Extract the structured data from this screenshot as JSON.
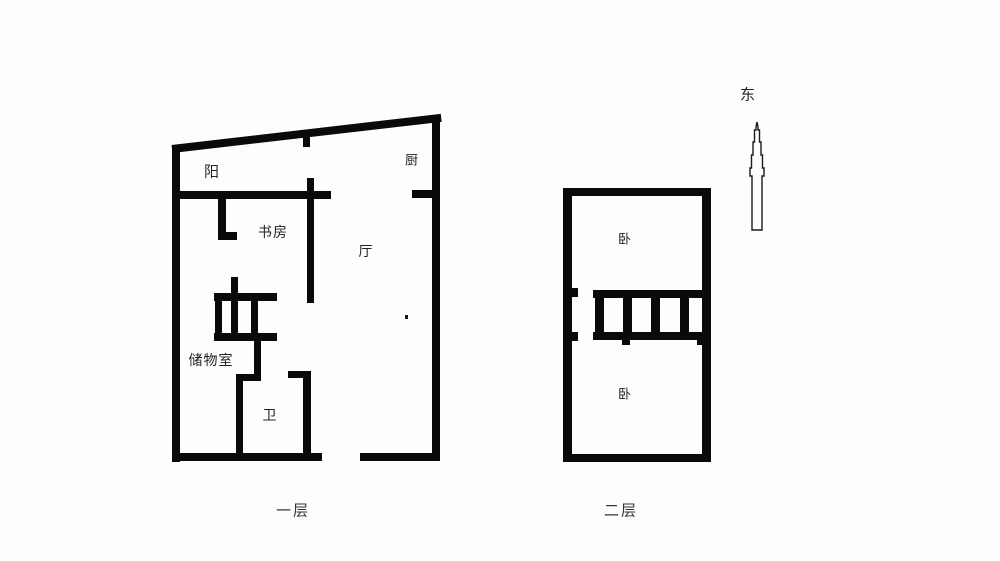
{
  "colors": {
    "background": "#fdfdfd",
    "wall": "#0a0a0a",
    "text": "#222222"
  },
  "compass": {
    "direction_label": "东"
  },
  "floor1": {
    "caption": "一层",
    "room_labels": {
      "balcony": "阳",
      "kitchen": "厨",
      "study": "书房",
      "living_room": "厅",
      "storage": "储物室",
      "bathroom": "卫"
    }
  },
  "floor2": {
    "caption": "二层",
    "room_labels": {
      "bedroom_upper": "卧",
      "bedroom_lower": "卧"
    }
  },
  "geometry": {
    "floor1_slant_wall": {
      "x": 172,
      "y": 145,
      "length": 271,
      "thickness": 8,
      "angle_deg": -6.6
    },
    "floor1_walls": [
      {
        "name": "left-wall",
        "x": 172,
        "y": 146,
        "w": 8,
        "h": 316
      },
      {
        "name": "right-wall",
        "x": 432,
        "y": 116,
        "w": 8,
        "h": 345
      },
      {
        "name": "slant-stub",
        "x": 303,
        "y": 130,
        "w": 7,
        "h": 17
      },
      {
        "name": "balcony-bottom-wall",
        "x": 176,
        "y": 191,
        "w": 155,
        "h": 8
      },
      {
        "name": "kitchen-stub",
        "x": 412,
        "y": 190,
        "w": 21,
        "h": 8
      },
      {
        "name": "study-hall-divider",
        "x": 307,
        "y": 178,
        "w": 7,
        "h": 125
      },
      {
        "name": "study-door-wall-v",
        "x": 218,
        "y": 199,
        "w": 8,
        "h": 41
      },
      {
        "name": "study-door-wall-foot",
        "x": 218,
        "y": 232,
        "w": 19,
        "h": 8
      },
      {
        "name": "stair-top-stub",
        "x": 231,
        "y": 277,
        "w": 7,
        "h": 17
      },
      {
        "name": "stair-top-bar",
        "x": 214,
        "y": 293,
        "w": 63,
        "h": 8
      },
      {
        "name": "stair-bar-1",
        "x": 215,
        "y": 301,
        "w": 7,
        "h": 32
      },
      {
        "name": "stair-bar-2",
        "x": 231,
        "y": 301,
        "w": 7,
        "h": 32
      },
      {
        "name": "stair-bar-3",
        "x": 251,
        "y": 301,
        "w": 7,
        "h": 32
      },
      {
        "name": "stair-bottom-bar",
        "x": 214,
        "y": 333,
        "w": 63,
        "h": 8
      },
      {
        "name": "below-stair-wall",
        "x": 254,
        "y": 341,
        "w": 7,
        "h": 40
      },
      {
        "name": "bath-left-wall-h",
        "x": 236,
        "y": 374,
        "w": 25,
        "h": 7
      },
      {
        "name": "bath-left-wall-v",
        "x": 236,
        "y": 374,
        "w": 7,
        "h": 83
      },
      {
        "name": "bath-right-wall-h",
        "x": 288,
        "y": 371,
        "w": 22,
        "h": 7
      },
      {
        "name": "bath-right-wall-v",
        "x": 303,
        "y": 371,
        "w": 8,
        "h": 86
      },
      {
        "name": "bottom-wall-left",
        "x": 172,
        "y": 453,
        "w": 150,
        "h": 8
      },
      {
        "name": "bottom-wall-right",
        "x": 360,
        "y": 453,
        "w": 80,
        "h": 8
      }
    ],
    "floor2_walls": [
      {
        "name": "top-wall",
        "x": 563,
        "y": 188,
        "w": 148,
        "h": 8
      },
      {
        "name": "left-wall",
        "x": 563,
        "y": 188,
        "w": 9,
        "h": 274
      },
      {
        "name": "right-wall",
        "x": 702,
        "y": 188,
        "w": 9,
        "h": 274
      },
      {
        "name": "bottom-wall",
        "x": 563,
        "y": 454,
        "w": 148,
        "h": 8
      },
      {
        "name": "stair-top-bar",
        "x": 593,
        "y": 290,
        "w": 117,
        "h": 8
      },
      {
        "name": "stair-bottom-bar",
        "x": 593,
        "y": 332,
        "w": 117,
        "h": 8
      },
      {
        "name": "stair-bar-1",
        "x": 595,
        "y": 290,
        "w": 9,
        "h": 50
      },
      {
        "name": "stair-bar-2",
        "x": 623,
        "y": 290,
        "w": 9,
        "h": 50
      },
      {
        "name": "stair-bar-3",
        "x": 651,
        "y": 290,
        "w": 9,
        "h": 50
      },
      {
        "name": "stair-bar-4",
        "x": 680,
        "y": 290,
        "w": 9,
        "h": 50
      },
      {
        "name": "stair-nub-1",
        "x": 622,
        "y": 340,
        "w": 8,
        "h": 5
      },
      {
        "name": "stair-nub-2",
        "x": 697,
        "y": 340,
        "w": 8,
        "h": 5
      },
      {
        "name": "left-wall-stub-1",
        "x": 572,
        "y": 288,
        "w": 6,
        "h": 9
      },
      {
        "name": "left-wall-stub-2",
        "x": 572,
        "y": 332,
        "w": 6,
        "h": 9
      }
    ],
    "artifact_dot": {
      "x": 405,
      "y": 315,
      "w": 3,
      "h": 4
    }
  }
}
